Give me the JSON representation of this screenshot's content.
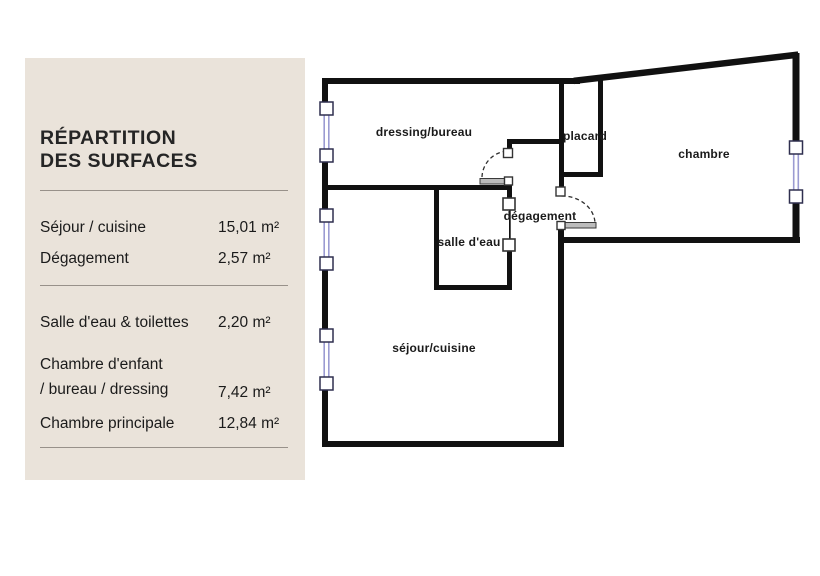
{
  "panel": {
    "background": "#eae3da",
    "title": {
      "line1": "RÉPARTITION",
      "line2": "DES SURFACES"
    },
    "rows": [
      {
        "label": "Séjour / cuisine",
        "value": "15,01 m²"
      },
      {
        "label": "Dégagement",
        "value": "2,57 m²"
      },
      {
        "label": "Salle d'eau & toilettes",
        "value": "2,20 m²"
      },
      {
        "label_line1": "Chambre d'enfant",
        "label_line2": "/ bureau / dressing",
        "value": "7,42 m²"
      },
      {
        "label": "Chambre principale",
        "value": "12,84 m²"
      }
    ]
  },
  "floorplan": {
    "rooms": [
      {
        "id": "dressing-bureau",
        "label": "dressing/bureau"
      },
      {
        "id": "placard",
        "label": "placard"
      },
      {
        "id": "chambre",
        "label": "chambre"
      },
      {
        "id": "degagement",
        "label": "dégagement"
      },
      {
        "id": "salle-deau",
        "label": "salle d'eau"
      },
      {
        "id": "sejour-cuisine",
        "label": "séjour/cuisine"
      }
    ],
    "colors": {
      "wall": "#111111",
      "window_glazing": "#9b9bd2",
      "window_frame": "#2f2f4f",
      "door_leaf": "#bcbcbc",
      "door_arc": "#2f2f2f",
      "label_text": "#1a1a1a"
    }
  }
}
